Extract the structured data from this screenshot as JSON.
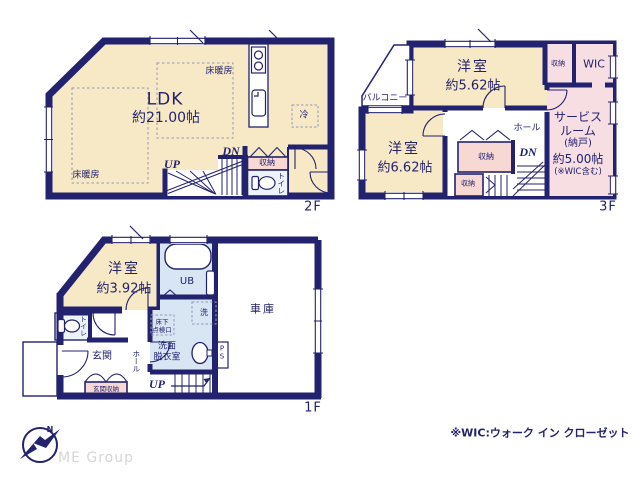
{
  "meta": {
    "drawing_type": "floor-plan",
    "floors_shown": [
      "2F",
      "3F",
      "1F"
    ]
  },
  "colors": {
    "wall": "#23226e",
    "room_cream": "#f7e9c5",
    "storage_pink": "#f7d8d3",
    "service_pink": "#f7dee3",
    "bath_blue": "#d8e6f4",
    "toilet_blue": "#ecf3fb",
    "text": "#23226e",
    "dash": "#9398bb",
    "logo_gray": "#d6d6d6"
  },
  "f2": {
    "label": "2F",
    "ldk_name": "LDK",
    "ldk_size": "約21.00帖",
    "floor_heating": "床暖房",
    "fridge": "冷",
    "up": "UP",
    "dn": "DN",
    "storage": "収納",
    "toilet": "トイレ"
  },
  "f3": {
    "label": "3F",
    "balcony": "バルコニー",
    "room1_name": "洋室",
    "room1_size": "約5.62帖",
    "room2_name": "洋室",
    "room2_size": "約6.62帖",
    "storage_top": "収納",
    "wic": "WIC",
    "service_name_1": "サービス",
    "service_name_2": "ルーム",
    "service_name_3": "(納戸)",
    "service_size": "約5.00帖",
    "service_note": "(※WIC含む)",
    "hall": "ホール",
    "dn": "DN",
    "storage_a": "収納",
    "storage_b": "収納"
  },
  "f1": {
    "label": "1F",
    "room_name": "洋室",
    "room_size": "約3.92帖",
    "ub": "UB",
    "washer": "洗",
    "underfloor_1": "床下",
    "underfloor_2": "点検口",
    "washroom_1": "洗面",
    "washroom_2": "脱衣室",
    "toilet": "トイレ",
    "entrance": "玄関",
    "entrance_storage": "玄関収納",
    "hall": "ホール",
    "up": "UP",
    "ps_1": "P",
    "ps_2": "S",
    "garage": "車庫"
  },
  "footer": {
    "wic_note": "※WIC:ウォーク イン クローゼット",
    "logo_text": "ME Group",
    "compass_n": "N"
  }
}
